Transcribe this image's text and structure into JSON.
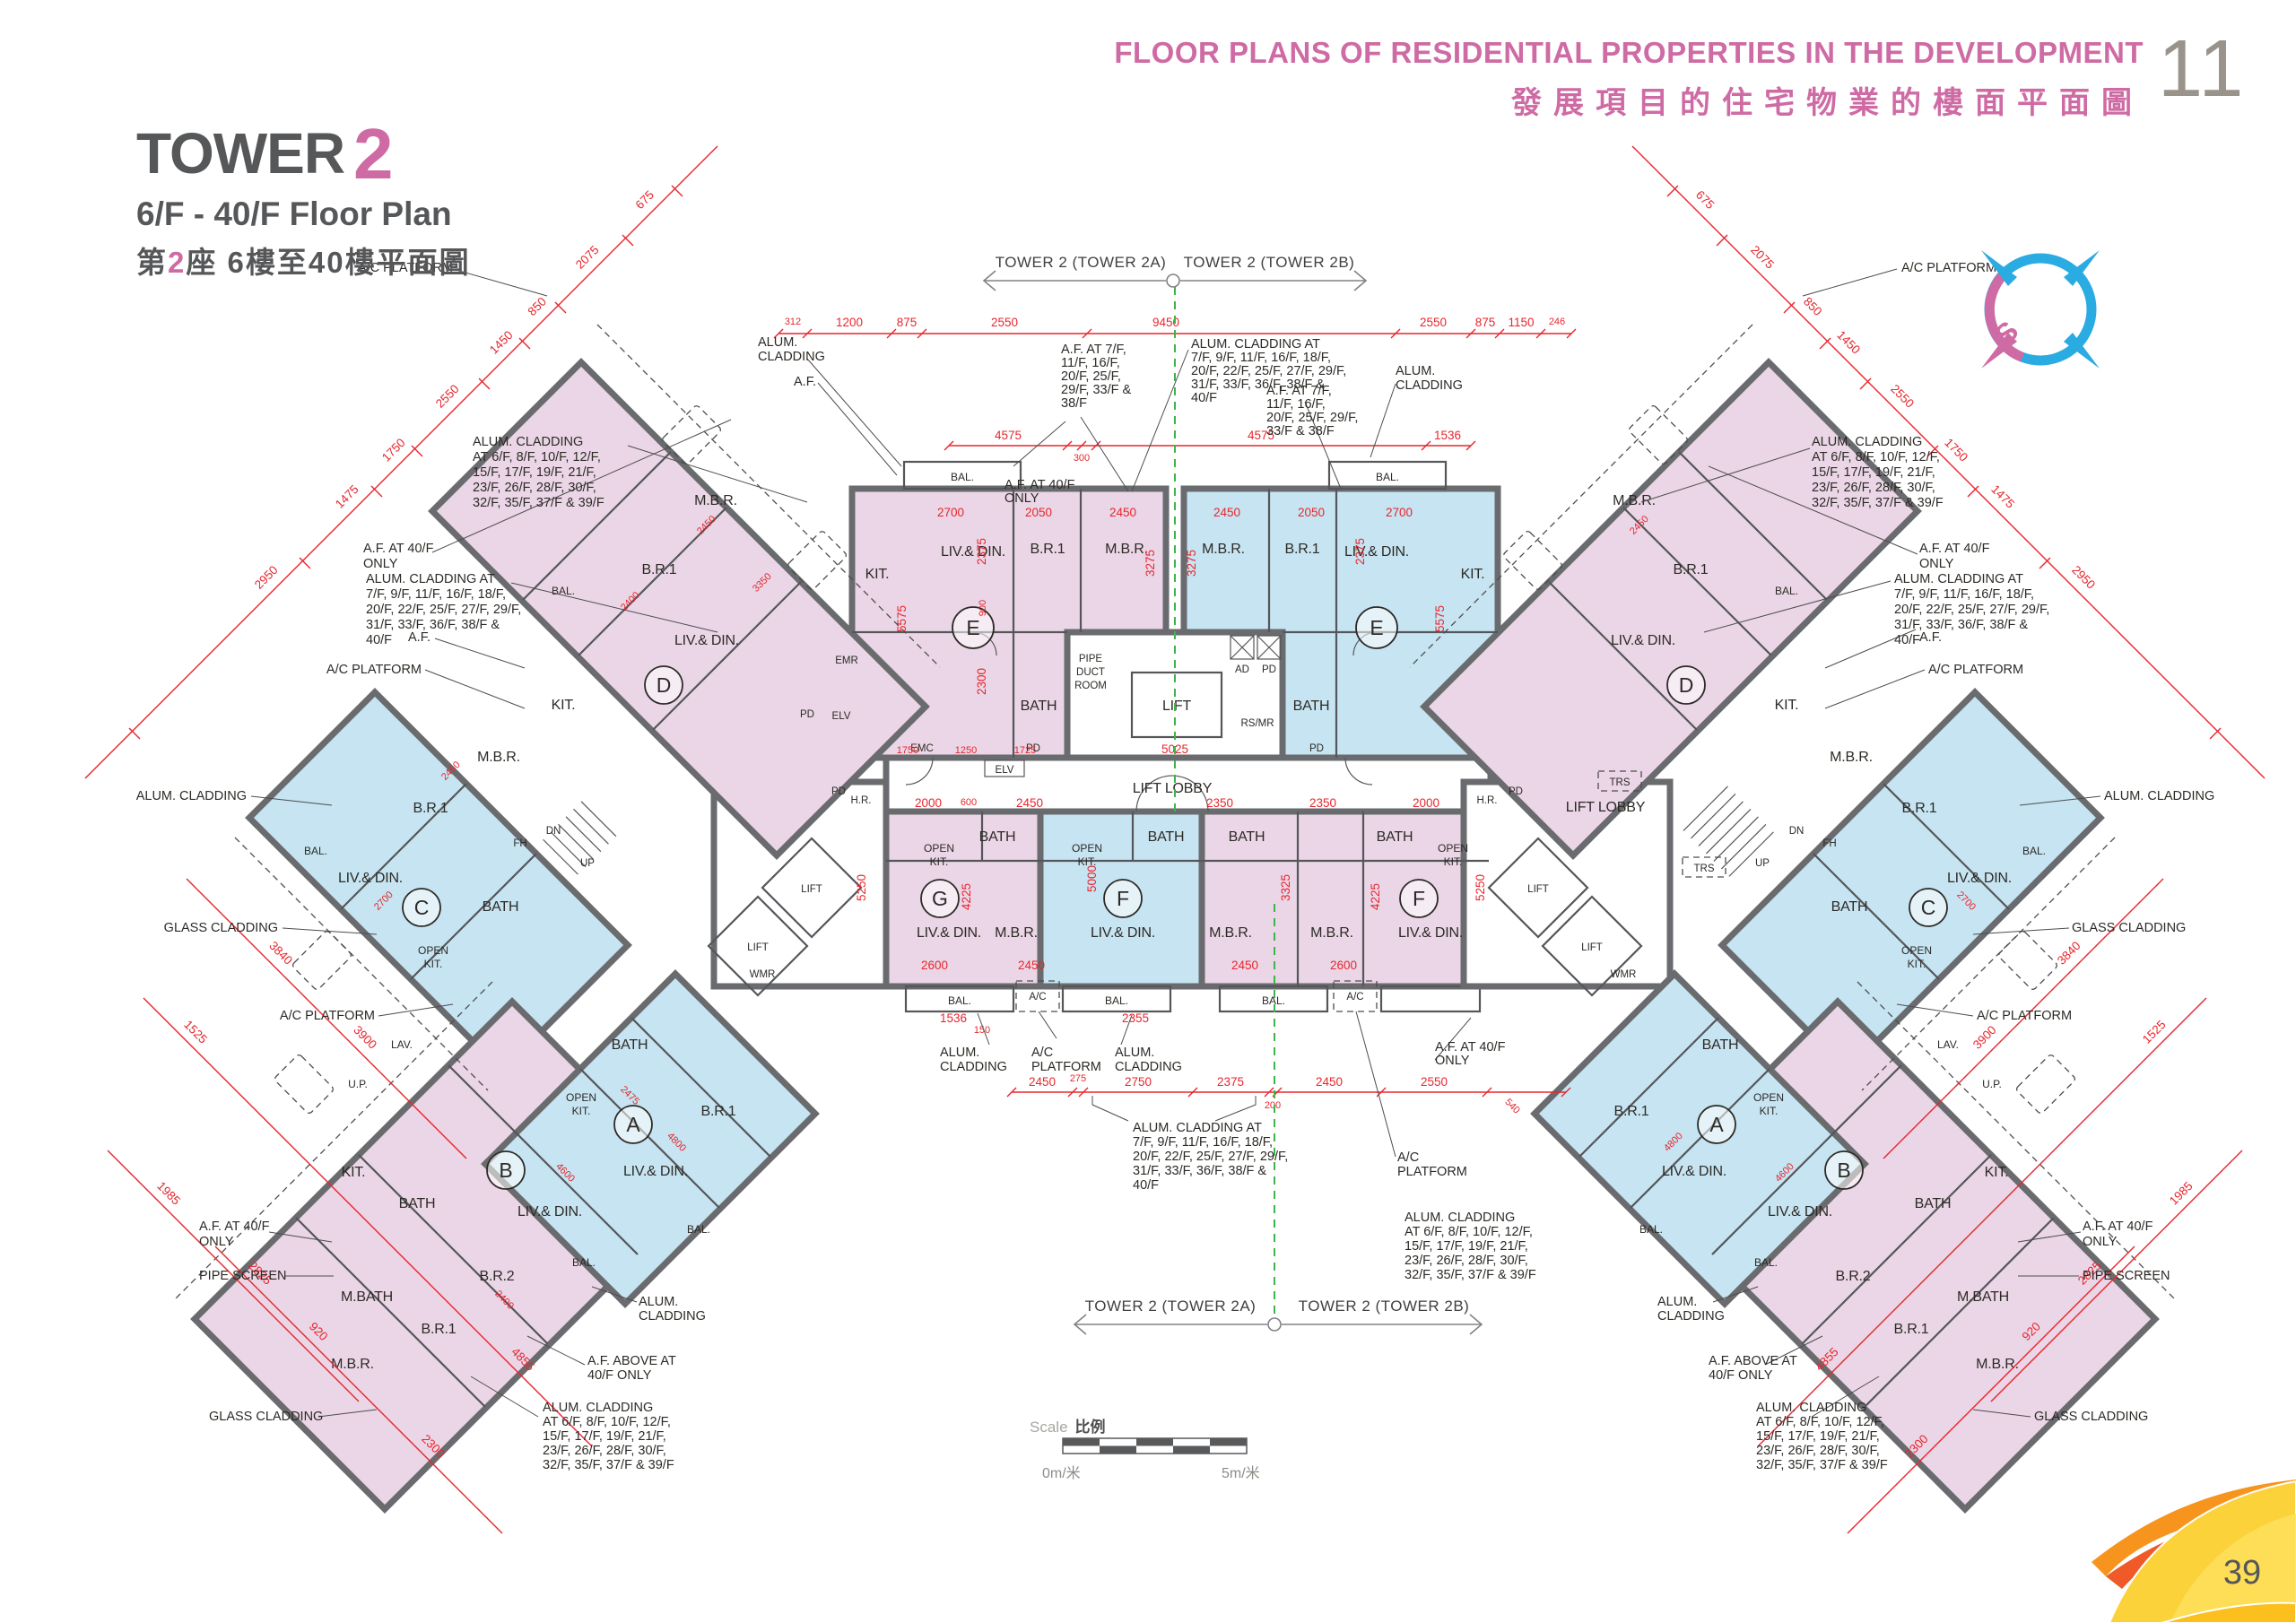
{
  "header": {
    "title_en": "FLOOR PLANS OF RESIDENTIAL PROPERTIES IN THE DEVELOPMENT",
    "title_zh": "發展項目的住宅物業的樓面平面圖",
    "corner": "11"
  },
  "title_block": {
    "tower": "TOWER",
    "num": "2",
    "floors_en": "6/F - 40/F Floor Plan",
    "zh_pre": "第",
    "zh_num": "2",
    "zh_post": "座 6樓至40樓平面圖"
  },
  "compass": {
    "s": "S"
  },
  "axis": {
    "a": "TOWER 2 (TOWER 2A)",
    "b": "TOWER 2 (TOWER 2B)"
  },
  "scalebar": {
    "en": "Scale",
    "zh": "比例",
    "zero": "0m/米",
    "five": "5m/米"
  },
  "watermark": {
    "zh": "好傢俬",
    "name": "hohomehk",
    "tld": ".com"
  },
  "page": {
    "number": "39"
  },
  "colors": {
    "pink": "#ead6e6",
    "blue": "#c6e4f1",
    "wall": "#6a6b6e",
    "red": "#e8262d",
    "green": "#3db54a",
    "accent": "#ce6ba4"
  },
  "units": {
    "A": "A",
    "B": "B",
    "C": "C",
    "D": "D",
    "E": "E",
    "F": "F",
    "G": "G"
  },
  "rooms": {
    "liv": "LIV.& DIN.",
    "mbr": "M.B.R.",
    "br1": "B.R.1",
    "br2": "B.R.2",
    "kit": "KIT.",
    "okit1": "OPEN",
    "okit2": "KIT.",
    "bath": "BATH",
    "mbath": "M.BATH",
    "bal": "BAL.",
    "up": "U.P.",
    "lav": "LAV.",
    "lift": "LIFT",
    "lobby": "LIFT LOBBY",
    "elv": "ELV",
    "pd": "PD",
    "ad": "AD",
    "hr": "H.R.",
    "wmr": "WMR",
    "trs": "TRS",
    "fh": "FH",
    "emc": "EMC",
    "emr": "EMR",
    "rsmr": "RS/MR",
    "pdr1": "PIPE",
    "pdr2": "DUCT",
    "pdr3": "ROOM",
    "sup": "UP",
    "sdn": "DN",
    "ac": "A/C"
  },
  "ann": {
    "af": "A.F.",
    "alum": "ALUM. CLADDING",
    "alum2": [
      "ALUM.",
      "CLADDING"
    ],
    "acp": "A/C PLATFORM",
    "acp2": [
      "A/C",
      "PLATFORM"
    ],
    "glass": "GLASS CLADDING",
    "pipe": "PIPE SCREEN",
    "af40": [
      "A.F. AT 40/F",
      "ONLY"
    ],
    "afabv": [
      "A.F. ABOVE AT",
      "40/F ONLY"
    ],
    "af7_5": [
      "A.F. AT 7/F,",
      "11/F, 16/F,",
      "20/F, 25/F,",
      "29/F, 33/F &",
      "38/F"
    ],
    "af7_4": [
      "A.F. AT 7/F,",
      "11/F, 16/F,",
      "20/F, 25/F, 29/F,",
      "33/F & 38/F"
    ],
    "alum_odd": [
      "ALUM. CLADDING AT",
      "7/F, 9/F, 11/F, 16/F, 18/F,",
      "20/F, 22/F, 25/F, 27/F, 29/F,",
      "31/F, 33/F, 36/F, 38/F &",
      "40/F"
    ],
    "alum_even": [
      "ALUM. CLADDING",
      "AT 6/F, 8/F, 10/F, 12/F,",
      "15/F, 17/F, 19/F, 21/F,",
      "23/F, 26/F, 28/F, 30/F,",
      "32/F, 35/F, 37/F & 39/F"
    ]
  },
  "dims": {
    "v150": "150",
    "v200": "200",
    "v246": "246",
    "v275": "275",
    "v300": "300",
    "v312": "312",
    "v540": "540",
    "v600": "600",
    "v675": "675",
    "v850": "850",
    "v875": "875",
    "v900": "900",
    "v920": "920",
    "v1150": "1150",
    "v1200": "1200",
    "v1250": "1250",
    "v1450": "1450",
    "v1475": "1475",
    "v1525": "1525",
    "v1536": "1536",
    "v1725": "1725",
    "v1750": "1750",
    "v1985": "1985",
    "v2000": "2000",
    "v2050": "2050",
    "v2075": "2075",
    "v2300": "2300",
    "v2350": "2350",
    "v2355": "2355",
    "v2375": "2375",
    "v2400": "2400",
    "v2450": "2450",
    "v2475": "2475",
    "v2550": "2550",
    "v2600": "2600",
    "v2700": "2700",
    "v2750": "2750",
    "v2825": "2825",
    "v2950": "2950",
    "v3275": "3275",
    "v3325": "3325",
    "v3350": "3350",
    "v3840": "3840",
    "v3900": "3900",
    "v4225": "4225",
    "v4575": "4575",
    "v4600": "4600",
    "v4800": "4800",
    "v4855": "4855",
    "v5000": "5000",
    "v5025": "5025",
    "v5250": "5250",
    "v5575": "5575",
    "v9450": "9450"
  }
}
